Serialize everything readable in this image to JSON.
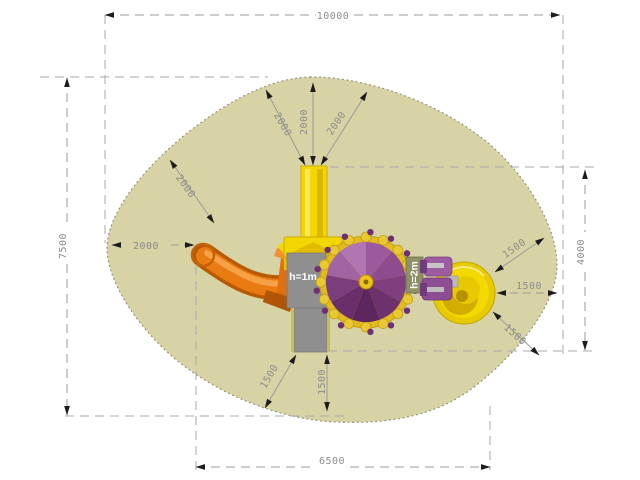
{
  "dims": {
    "overall_width": "10000",
    "overall_height": "7500",
    "footprint_width": "6500",
    "footprint_height": "4000",
    "clearance_slide_left": "2000",
    "clearance_slide_diag": "2000",
    "clearance_tower_up_left": "2000",
    "clearance_tower_up": "2000",
    "clearance_tower_up_right": "2000",
    "clearance_dish_up_right": "1500",
    "clearance_dish_right": "1500",
    "clearance_dish_down_right": "1500",
    "clearance_platform_down_left": "1500",
    "clearance_platform_down": "1500"
  },
  "labels": {
    "platform_height": "h=1m",
    "tower_height": "h=2m"
  },
  "colors": {
    "safety_area": "#d7d3a5",
    "slide": "#ea7b13",
    "tower": "#f2d703",
    "carousel": "#8e4b8e",
    "dish": "#e8ca00",
    "spring_rider": "#9c5ca2",
    "platform": "#8f8f8f",
    "dimension_text": "#8c8c8c"
  }
}
